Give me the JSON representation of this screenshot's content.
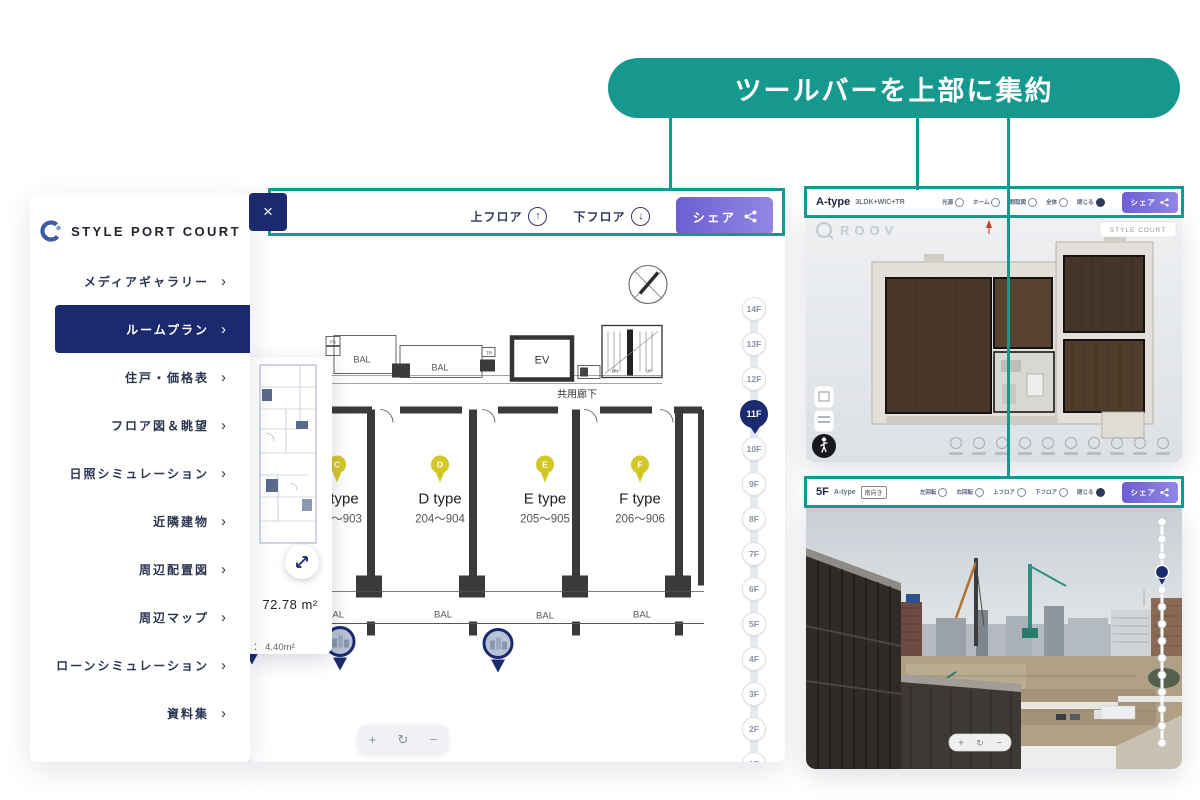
{
  "banner": {
    "label": "ツールバーを上部に集約",
    "accent_color": "#16988f"
  },
  "sidebar": {
    "logo": "STYLE PORT COURT",
    "chevron": "›",
    "active_item": "ルームプラン",
    "items": [
      {
        "label": "メディアギャラリー"
      },
      {
        "label": "ルームプラン"
      },
      {
        "label": "住戸・価格表"
      },
      {
        "label": "フロア図＆眺望"
      },
      {
        "label": "日照シミュレーション"
      },
      {
        "label": "近隣建物"
      },
      {
        "label": "周辺配置図"
      },
      {
        "label": "周辺マップ"
      },
      {
        "label": "ローンシミュレーション"
      },
      {
        "label": "資料集"
      }
    ]
  },
  "main": {
    "close": "×",
    "toolbar": {
      "up": "上フロア",
      "down": "下フロア",
      "share": "シェア",
      "up_arrow": "↑",
      "down_arrow": "↓"
    },
    "floors": [
      "14F",
      "13F",
      "12F",
      "11F",
      "10F",
      "9F",
      "8F",
      "7F",
      "6F",
      "5F",
      "4F",
      "3F",
      "2F",
      "1F"
    ],
    "active_floor": "11F",
    "units": [
      {
        "pin": "C",
        "name": "C type",
        "range": "203〜903"
      },
      {
        "pin": "D",
        "name": "D type",
        "range": "204〜904"
      },
      {
        "pin": "E",
        "name": "E type",
        "range": "205〜905"
      },
      {
        "pin": "F",
        "name": "F type",
        "range": "206〜906"
      }
    ],
    "plan": {
      "bal": "BAL",
      "ev": "EV",
      "corridor": "共用廊下",
      "dn": "DN",
      "up": "UP",
      "ps": "PS",
      "tr": "TR"
    },
    "thumb": {
      "area": "72.78 m²",
      "sub": "： 4.40m²"
    },
    "zoomctl": {
      "plus": "+",
      "reset": "↻",
      "minus": "−"
    },
    "accent_navy": "#1b2a6e",
    "pin_yellow": "#d3c727",
    "share_purple": "#7e6fd9"
  },
  "panel3d": {
    "title": "A-type",
    "subtitle": "3LDK+WIC+TR",
    "tools": [
      {
        "label": "光源"
      },
      {
        "label": "ホーム"
      },
      {
        "label": "間取図"
      },
      {
        "label": "全体"
      },
      {
        "label": "閉じる"
      }
    ],
    "share": "シェア",
    "watermark": "ROOV",
    "badge": "STYLE COURT"
  },
  "panelview": {
    "title": "5F",
    "subtitle": "A-type",
    "badge": "南向き",
    "tools": [
      {
        "label": "左回転"
      },
      {
        "label": "右回転"
      },
      {
        "label": "上フロア"
      },
      {
        "label": "下フロア"
      },
      {
        "label": "閉じる"
      }
    ],
    "share": "シェア",
    "zoomctl": {
      "plus": "+",
      "reset": "↻",
      "minus": "−"
    }
  }
}
